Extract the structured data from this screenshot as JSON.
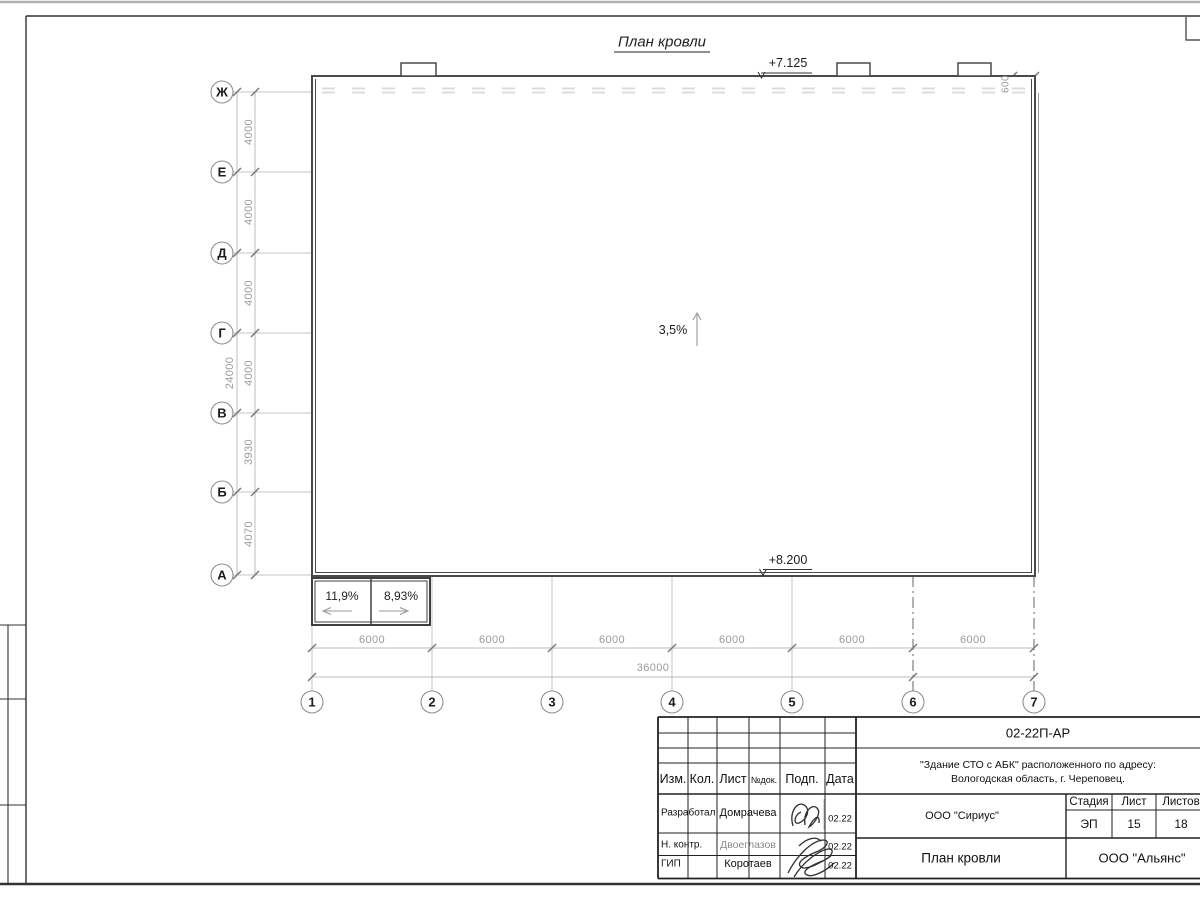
{
  "drawing": {
    "title": "План кровли",
    "roof": {
      "slope_label": "3,5%",
      "elev_top": "+7.125",
      "elev_bottom": "+8.200",
      "parapet_offset": "600"
    },
    "annex": {
      "slope_left": "11,9%",
      "slope_right": "8,93%"
    },
    "axes": {
      "rows": [
        "Ж",
        "Е",
        "Д",
        "Г",
        "В",
        "Б",
        "А"
      ],
      "row_dims": [
        "4000",
        "4000",
        "4000",
        "4000",
        "3930",
        "4070"
      ],
      "row_total": "24000",
      "cols": [
        "1",
        "2",
        "3",
        "4",
        "5",
        "6",
        "7"
      ],
      "col_dims": [
        "6000",
        "6000",
        "6000",
        "6000",
        "6000",
        "6000"
      ],
      "col_total": "36000"
    }
  },
  "titleblock": {
    "doc_number": "02-22П-АР",
    "project_line1": "\"Здание СТО с АБК\" расположенного по адресу:",
    "project_line2": "Вологодская область, г. Череповец.",
    "designer_org": "ООО \"Сириус\"",
    "customer_org": "ООО \"Альянс\"",
    "sheet_title": "План кровли",
    "stage_label": "Стадия",
    "stage_value": "ЭП",
    "sheet_label": "Лист",
    "sheet_value": "15",
    "sheets_label": "Листов",
    "sheets_value": "18",
    "header": {
      "izm": "Изм.",
      "kol": "Кол.",
      "list": "Лист",
      "ndok": "№док.",
      "podp": "Подп.",
      "data": "Дата"
    },
    "rows": [
      {
        "role": "Разработал",
        "name": "Домрачева",
        "date": "02.22"
      },
      {
        "role": "Н. контр.",
        "name": "Двоеглазов",
        "date": "02.22"
      },
      {
        "role": "ГИП",
        "name": "Коротаев",
        "date": "02.22"
      }
    ]
  }
}
